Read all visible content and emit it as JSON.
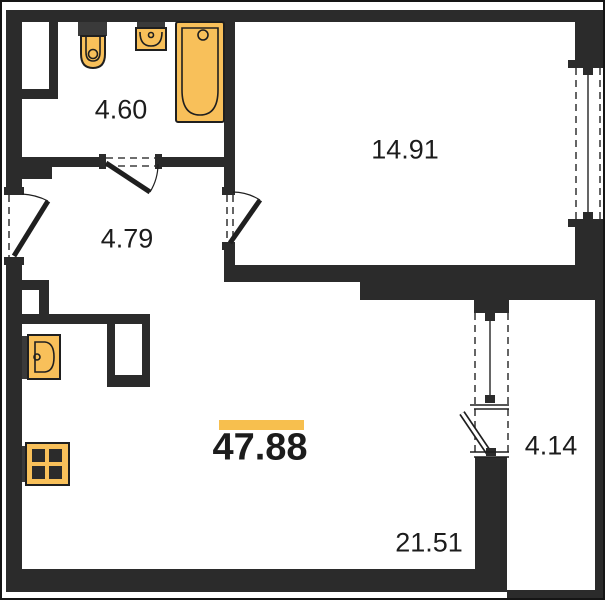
{
  "floorplan": {
    "total_area": "47.88",
    "rooms": [
      {
        "name": "bathroom",
        "area": "4.60"
      },
      {
        "name": "room",
        "area": "14.91"
      },
      {
        "name": "hallway",
        "area": "4.79"
      },
      {
        "name": "living-kitchen",
        "area": "21.51"
      },
      {
        "name": "balcony",
        "area": "4.14"
      }
    ],
    "fixtures": [
      "toilet",
      "bathroom-sink",
      "bathtub",
      "kitchen-sink",
      "stove"
    ],
    "colors": {
      "wall": "#2b2b2b",
      "fixture-fill": "#f8c05a",
      "fixture-dark": "#3a3a3a",
      "accent": "#f7bf4e",
      "text": "#1c1c1c"
    }
  }
}
